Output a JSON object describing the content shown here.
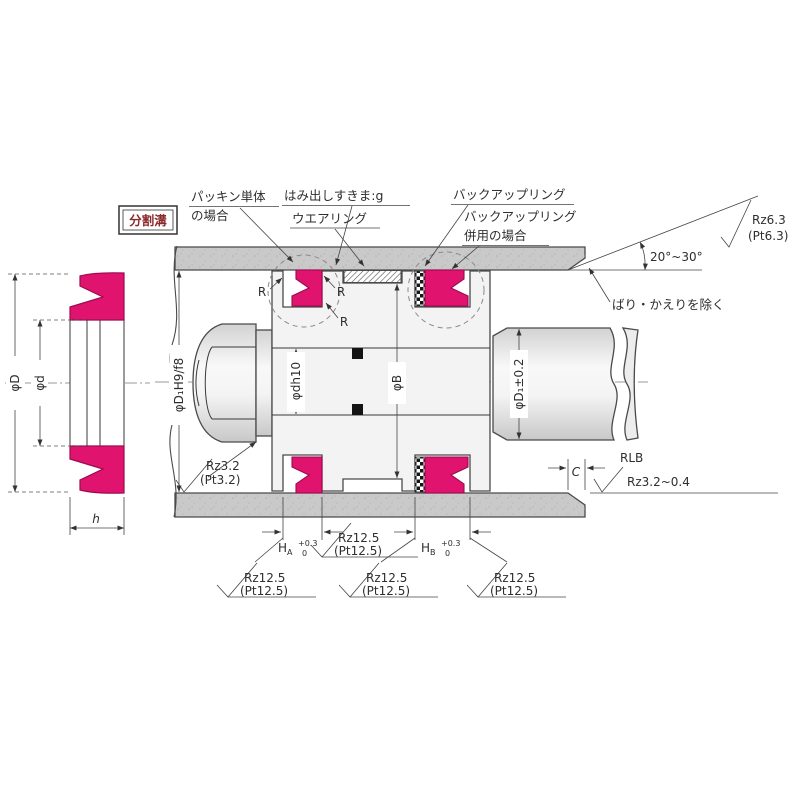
{
  "title": "ピストンパッキン取付部 断面図",
  "labels": {
    "split_groove": "分割溝",
    "packing_single_1": "パッキン単体",
    "packing_single_2": "の場合",
    "protrusion_gap": "はみ出しすきま:g",
    "wear_ring": "ウエアリング",
    "backup_ring": "バックアップリング",
    "backup_combined_1": "バックアップリング",
    "backup_combined_2": "併用の場合",
    "chamfer_angle": "20°~30°",
    "deburr": "ばり・かえりを除く",
    "rz63": "Rz6.3",
    "pt63": "(Pt6.3)",
    "rz32": "Rz3.2",
    "pt32": "(Pt3.2)",
    "rz125": "Rz12.5",
    "pt125": "(Pt12.5)",
    "rlb": "RLB",
    "rlb_rough": "Rz3.2~0.4",
    "phi_D": "φD",
    "phi_d": "φd",
    "h": "h",
    "phi_D1_fit": "φD₁H9/f8",
    "phi_dh10": "φdh10",
    "phi_B": "φB",
    "phi_D1_tol": "φD₁±0.2",
    "c": "C",
    "r": "R",
    "h_main": "H",
    "sub_a": "A",
    "sub_b": "B",
    "tol_plus": "+0.3",
    "tol_zero": "0"
  },
  "colors": {
    "seal_pink": "#e0146e",
    "seal_edge": "#9c0a4e",
    "wall_gray": "#c9c9c9",
    "metal_light": "#f3f3f3",
    "line": "#3a3a3a",
    "boxed_label_text": "#8b2a2a"
  }
}
